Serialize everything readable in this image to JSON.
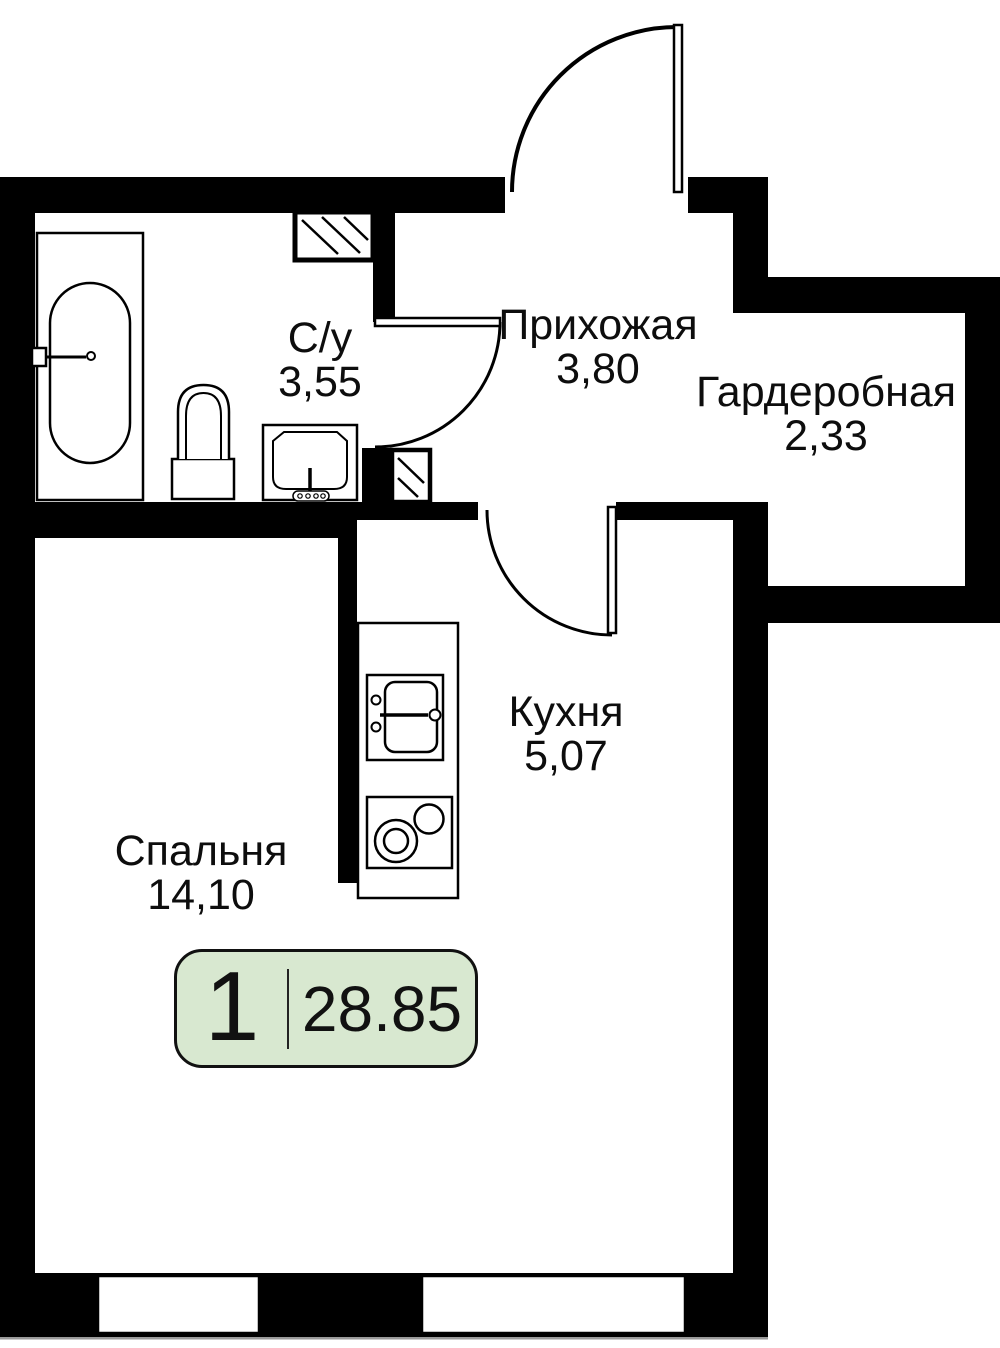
{
  "plan": {
    "badge": {
      "rooms_count": "1",
      "total_area": "28.85",
      "bg_color": "#d8e8d0"
    },
    "rooms": [
      {
        "id": "bathroom",
        "label": "С/у",
        "area": "3,55"
      },
      {
        "id": "hallway",
        "label": "Прихожая",
        "area": "3,80"
      },
      {
        "id": "wardrobe",
        "label": "Гардеробная",
        "area": "2,33"
      },
      {
        "id": "kitchen",
        "label": "Кухня",
        "area": "5,07"
      },
      {
        "id": "bedroom",
        "label": "Спальня",
        "area": "14,10"
      }
    ],
    "colors": {
      "wall": "#000000",
      "floor": "#ffffff"
    },
    "fixtures": [
      "bathtub",
      "toilet",
      "washbasin",
      "kitchen-sink",
      "stove",
      "ventilation-shaft",
      "ventilation-shaft-small"
    ],
    "doors": [
      "entrance-door",
      "bathroom-door",
      "kitchen-door"
    ],
    "windows_count": "2"
  }
}
